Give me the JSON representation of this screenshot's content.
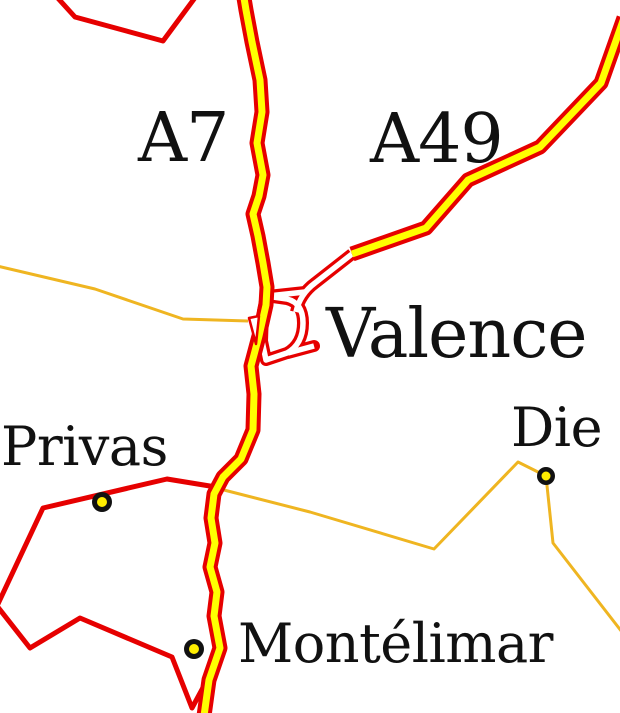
{
  "colors": {
    "background": "#ffffff",
    "road_red": "#e60000",
    "motorway_core_yellow": "#ffff00",
    "secondary_road_orange": "#efb521",
    "city_marker_fill": "#ffee00",
    "city_marker_ring": "#111111",
    "label_black": "#111111"
  },
  "road_labels": {
    "motorway_a7": "A7",
    "motorway_a49": "A49"
  },
  "cities": [
    {
      "name": "Valence"
    },
    {
      "name": "Privas"
    },
    {
      "name": "Die"
    },
    {
      "name": "Montélimar"
    }
  ]
}
